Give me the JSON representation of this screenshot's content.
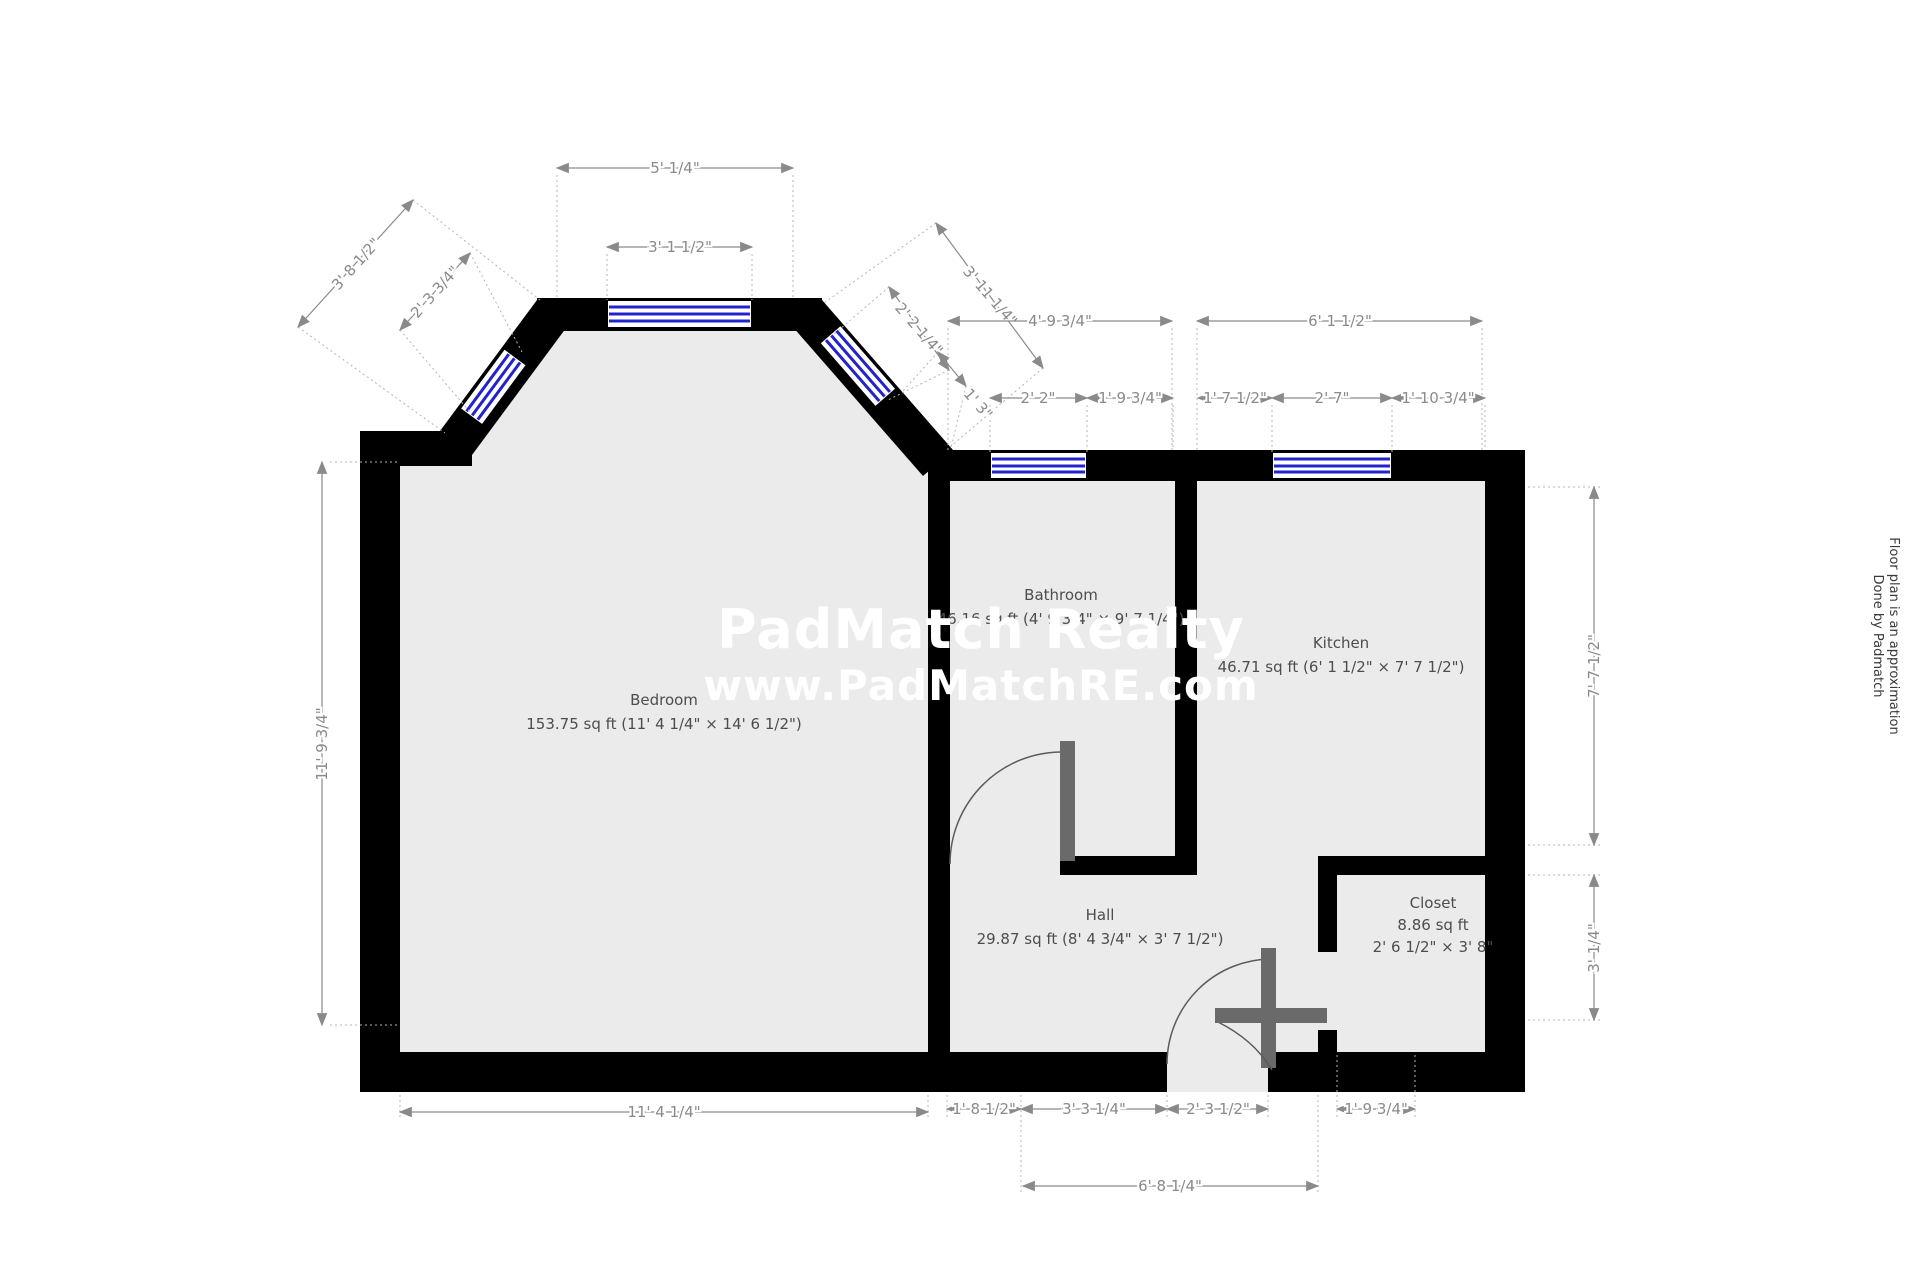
{
  "watermark": {
    "line1": "PadMatch Realty",
    "line2": "www.PadMatchRE.com"
  },
  "side_note": {
    "line1": "Floor plan is an approximation",
    "line2": "Done by Padmatch"
  },
  "rooms": {
    "bedroom": {
      "name": "Bedroom",
      "area": "153.75 sq ft (11' 4 1/4\" × 14' 6 1/2\")"
    },
    "bathroom": {
      "name": "Bathroom",
      "area": "46.16 sq ft (4' 9 3/4\" × 9' 7 1/4\")"
    },
    "kitchen": {
      "name": "Kitchen",
      "area": "46.71 sq ft (6' 1 1/2\" × 7' 7 1/2\")"
    },
    "hall": {
      "name": "Hall",
      "area": "29.87 sq ft (8' 4 3/4\" × 3' 7 1/2\")"
    },
    "closet": {
      "name": "Closet",
      "area": "8.86 sq ft",
      "dims": "2' 6 1/2\" × 3' 8\""
    }
  },
  "dims": {
    "bay_width": "5' 1/4\"",
    "bay_window": "3' 1 1/2\"",
    "diag_left_wall": "3' 8 1/2\"",
    "diag_left_window": "2' 3 3/4\"",
    "diag_right_wall": "3' 11 1/4\"",
    "diag_right_window": "2' 2 1/4\"",
    "diag_right_corner": "1' 3\"",
    "bath_width": "4' 9 3/4\"",
    "kitchen_width": "6' 1 1/2\"",
    "bath_window_offset": "2' 2\"",
    "bath_window_right": "1' 9 3/4\"",
    "kitchen_left_offset": "1' 7 1/2\"",
    "kitchen_window": "2' 7\"",
    "kitchen_right_offset": "1' 10 3/4\"",
    "bedroom_height": "11' 9 3/4\"",
    "kitchen_height": "7' 7 1/2\"",
    "closet_height": "3' 1/4\"",
    "bedroom_width": "11' 4 1/4\"",
    "hall_left": "1' 8 1/2\"",
    "hall_mid": "3' 3 1/4\"",
    "entry_door": "2' 3 1/2\"",
    "closet_bottom": "1' 9 3/4\"",
    "hall_total": "6' 8 1/4\""
  },
  "colors": {
    "wall": "#000000",
    "floor": "#ebebeb",
    "window": "#2323cd",
    "dimension": "#8a8a8a",
    "door": "#6a6a6a",
    "watermark": "#ffffff"
  }
}
